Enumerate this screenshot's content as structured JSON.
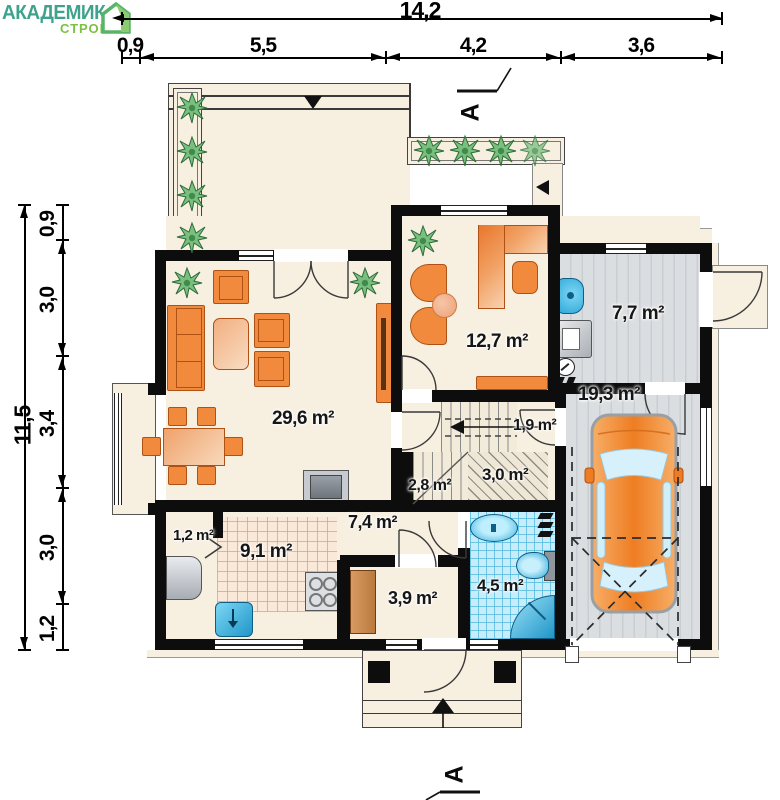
{
  "brand": {
    "name": "АКАДЕМИК",
    "sub": "СТРОЙ",
    "teal": "#3FA28C",
    "green": "#7CC142"
  },
  "dimensions": {
    "top_total": "14,2",
    "top_segments": [
      "0,9",
      "5,5",
      "4,2",
      "3,6"
    ],
    "left_total": "11,5",
    "left_segments": [
      "0,9",
      "3,0",
      "3,4",
      "3,0",
      "1,2"
    ]
  },
  "section_marker": "A",
  "rooms": {
    "living": {
      "area": "29,6 m²"
    },
    "office": {
      "area": "12,7 m²"
    },
    "utility": {
      "area": "7,7 m²"
    },
    "garage": {
      "area": "19,3 m²"
    },
    "corridor": {
      "area": "1,9 m²"
    },
    "stairs": {
      "area": "2,8 m²"
    },
    "hall": {
      "area": "3,0 m²"
    },
    "hallway": {
      "area": "7,4 m²"
    },
    "kitchen": {
      "area": "9,1 m²"
    },
    "pantry": {
      "area": "1,2 m²"
    },
    "vestibule": {
      "area": "3,9 m²"
    },
    "bathroom": {
      "area": "4,5 m²"
    }
  }
}
